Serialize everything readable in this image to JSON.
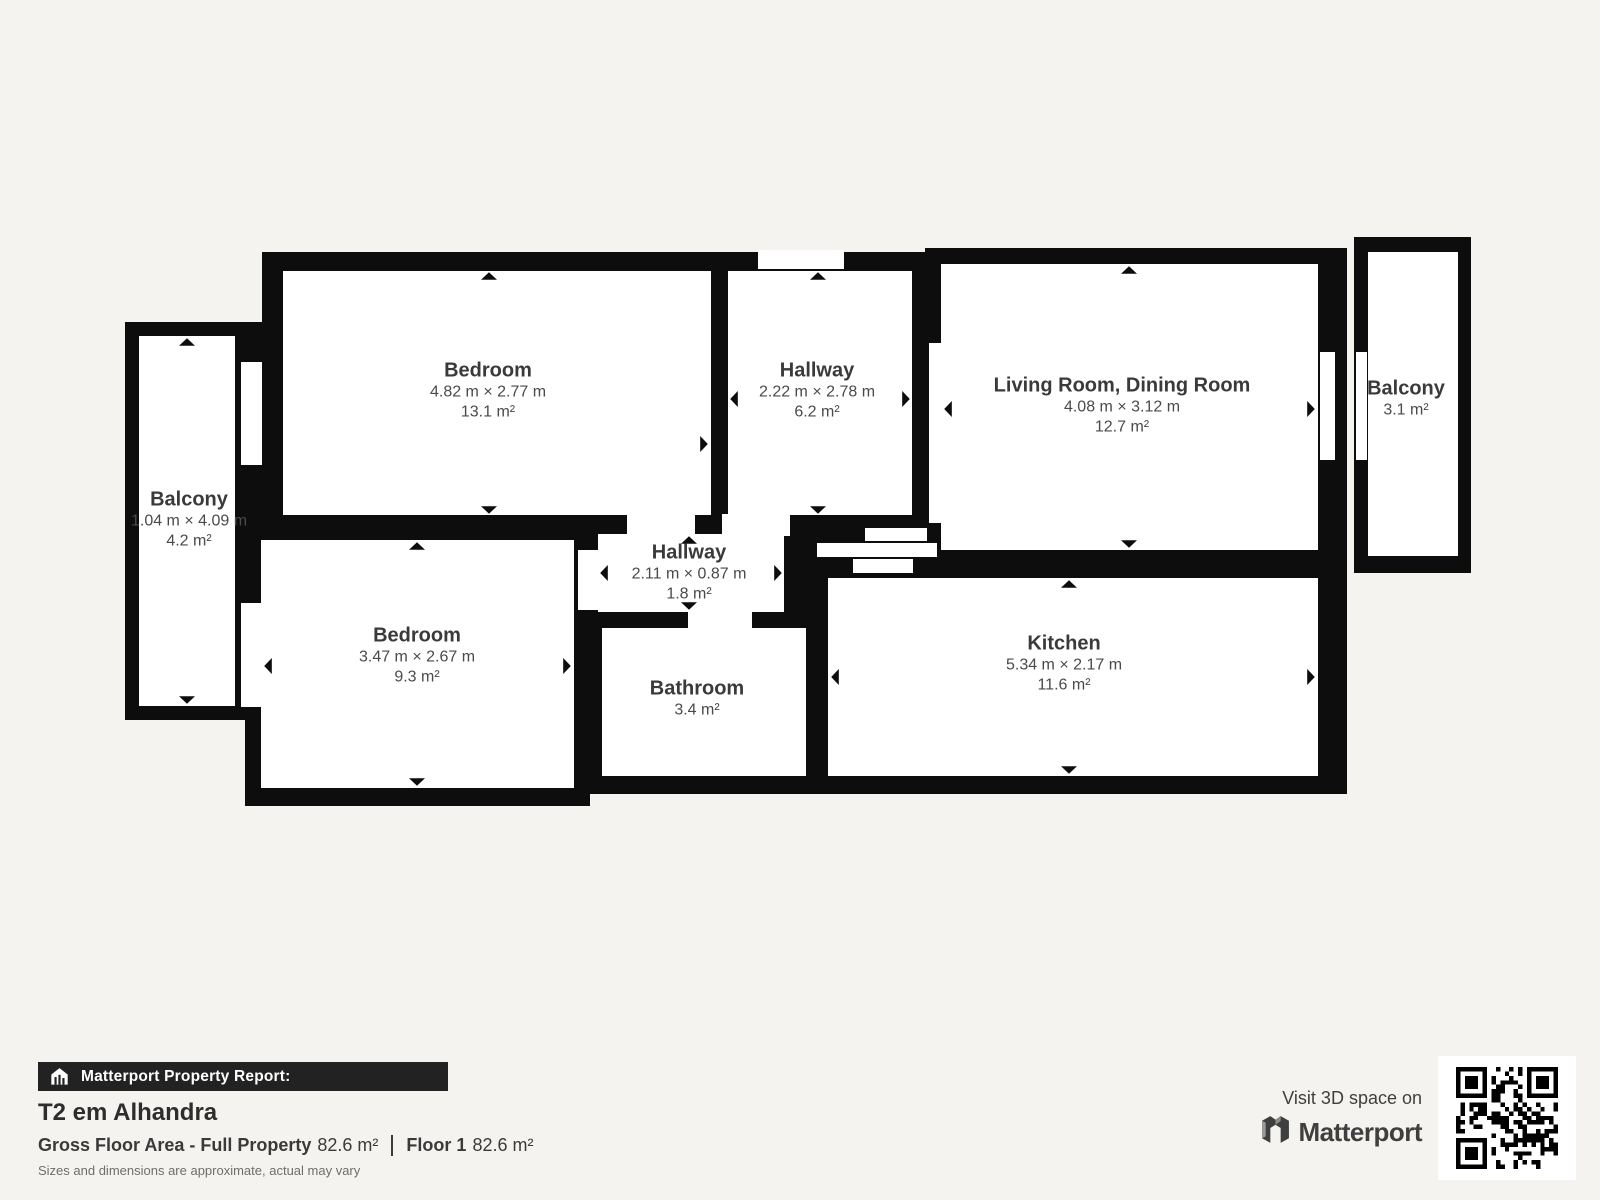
{
  "colors": {
    "background": "#f4f3f0",
    "wall": "#0d0d0d",
    "room_fill": "#ffffff",
    "room_name_text": "#3a3a3a",
    "room_dim_text": "#4a4a4a",
    "report_bar_bg": "#222222",
    "report_bar_text": "#ffffff"
  },
  "rooms": [
    {
      "id": "bedroom-1",
      "name": "Bedroom",
      "dimensions": "4.82 m × 2.77 m",
      "area": "13.1 m²"
    },
    {
      "id": "hallway-1",
      "name": "Hallway",
      "dimensions": "2.22 m × 2.78 m",
      "area": "6.2 m²"
    },
    {
      "id": "living-dining",
      "name": "Living Room, Dining Room",
      "dimensions": "4.08 m × 3.12 m",
      "area": "12.7 m²"
    },
    {
      "id": "balcony-right",
      "name": "Balcony",
      "area": "3.1 m²"
    },
    {
      "id": "balcony-left",
      "name": "Balcony",
      "dimensions": "1.04 m × 4.09 m",
      "area": "4.2 m²"
    },
    {
      "id": "bedroom-2",
      "name": "Bedroom",
      "dimensions": "3.47 m × 2.67 m",
      "area": "9.3 m²"
    },
    {
      "id": "hallway-2",
      "name": "Hallway",
      "dimensions": "2.11 m × 0.87 m",
      "area": "1.8 m²"
    },
    {
      "id": "bathroom",
      "name": "Bathroom",
      "area": "3.4 m²"
    },
    {
      "id": "kitchen",
      "name": "Kitchen",
      "dimensions": "5.34 m × 2.17 m",
      "area": "11.6 m²"
    }
  ],
  "report": {
    "header": "Matterport Property Report:",
    "property_title": "T2 em Alhandra",
    "gross_label": "Gross Floor Area - Full Property",
    "gross_value": "82.6 m²",
    "floor_label": "Floor 1",
    "floor_value": "82.6 m²",
    "disclaimer": "Sizes and dimensions are approximate, actual may vary"
  },
  "cta": {
    "line1": "Visit 3D space on",
    "brand": "Matterport"
  },
  "icons": {
    "report_header": "house-bars-icon",
    "brand": "matterport-m-icon",
    "qr": "qr-code-icon"
  }
}
